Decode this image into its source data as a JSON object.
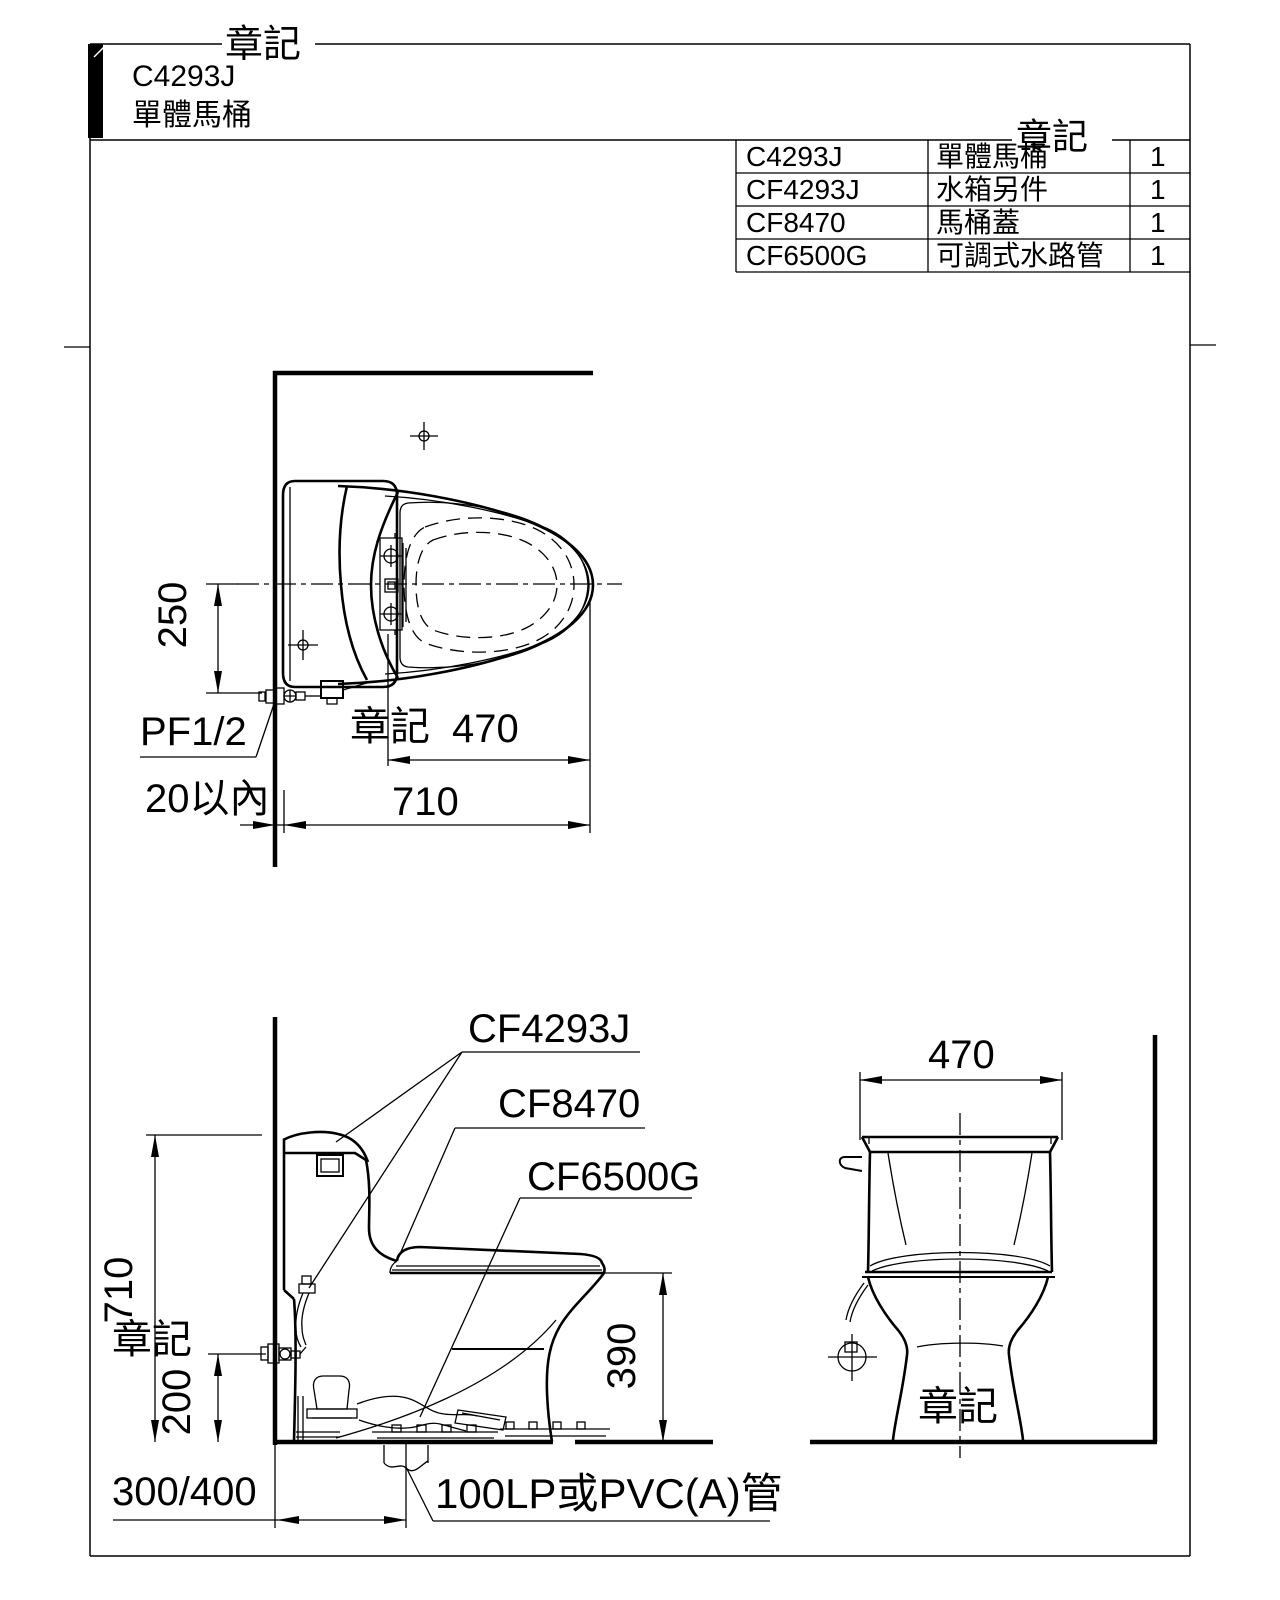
{
  "title_block": {
    "watermark": "章記",
    "model": "C4293J",
    "product_name": "單體馬桶"
  },
  "parts_table": {
    "watermark": "章記",
    "rows": [
      {
        "code": "C4293J",
        "name": "單體馬桶",
        "qty": "1"
      },
      {
        "code": "CF4293J",
        "name": "水箱另件",
        "qty": "1"
      },
      {
        "code": "CF8470",
        "name": "馬桶蓋",
        "qty": "1"
      },
      {
        "code": "CF6500G",
        "name": "可調式水路管",
        "qty": "1"
      }
    ]
  },
  "top_view": {
    "watermark": "章記",
    "dim_depth_to_inlet": "250",
    "inlet_label": "PF1/2",
    "dim_seat_length": "470",
    "dim_total_length": "710",
    "wall_clearance": "20以內"
  },
  "side_view": {
    "watermark": "章記",
    "label_tank_parts": "CF4293J",
    "label_seat_cover": "CF8470",
    "label_water_pipe": "CF6500G",
    "dim_height": "710",
    "dim_inlet_height": "200",
    "dim_seat_height": "390",
    "dim_rough_in": "300/400",
    "drain_note": "100LP或PVC(A)管"
  },
  "front_view": {
    "watermark": "章記",
    "dim_width": "470"
  },
  "colors": {
    "ink": "#000000",
    "paper": "#ffffff"
  }
}
